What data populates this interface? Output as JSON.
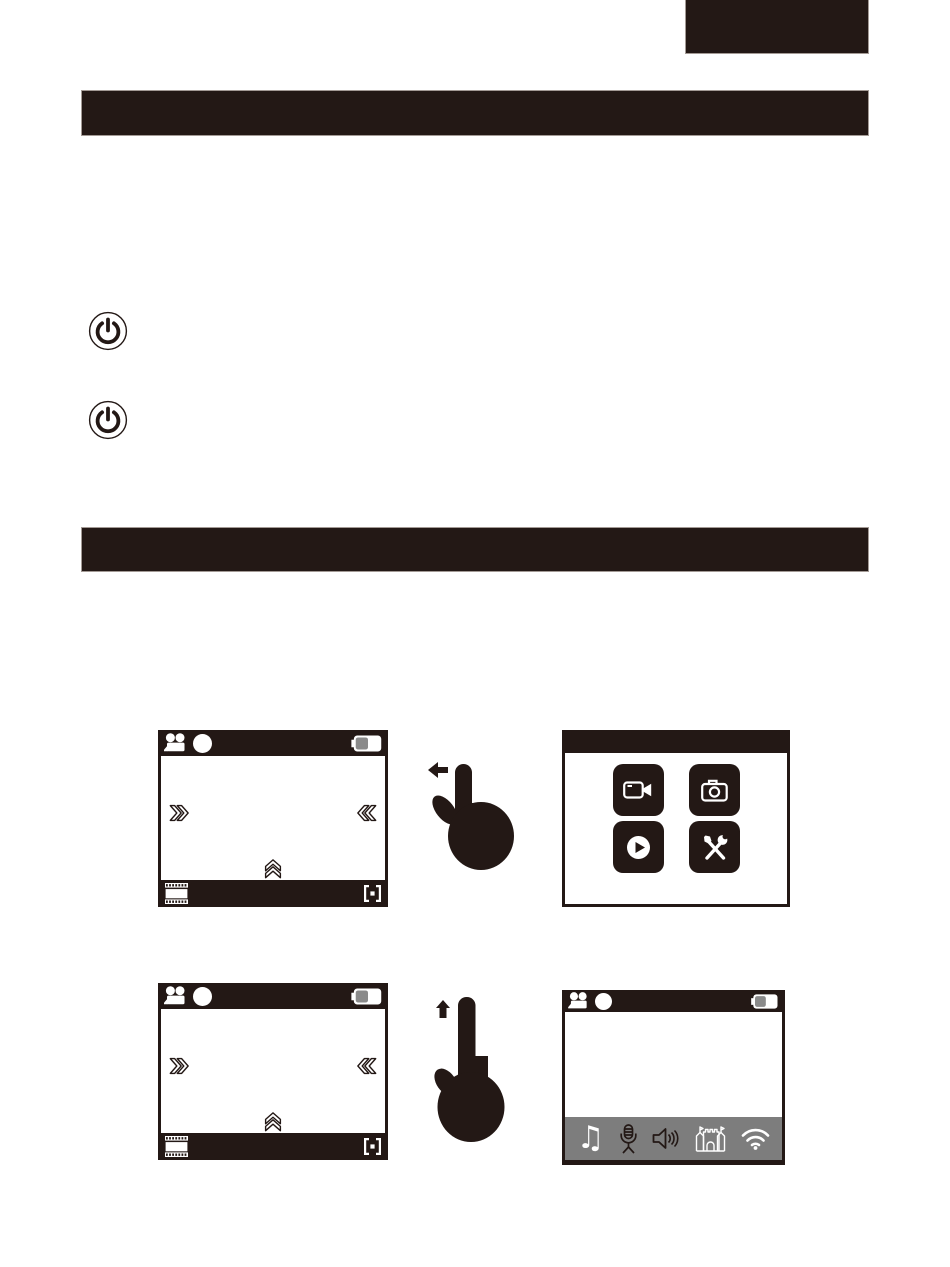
{
  "palette": {
    "ink": "#231815",
    "paper": "#ffffff",
    "toolbar_gray": "#7d7d7d",
    "battery_fill_gray": "#8a8a8a"
  },
  "corner_tab": {
    "text": ""
  },
  "section_bars": [
    {
      "text": ""
    },
    {
      "text": ""
    }
  ],
  "bullets": [
    {
      "icon": "power-icon"
    },
    {
      "icon": "power-icon"
    }
  ],
  "camera_screen_template": {
    "statusbar_icons": [
      "video-recorder-icon",
      "record-dot",
      "battery-icon"
    ],
    "overlay_icons": [
      "double-chevron-right",
      "double-chevron-left",
      "double-chevron-up"
    ],
    "footer_icons": [
      "film-strip-icon",
      "focus-frame-icon"
    ]
  },
  "figure_row1": {
    "left_screen": "camera-live-view",
    "gesture": {
      "icon": "swipe-left-hand-icon",
      "arrow_direction": "left"
    },
    "right_screen": "mode-menu",
    "menu_buttons": [
      {
        "icon": "video-camera-icon"
      },
      {
        "icon": "photo-camera-icon"
      },
      {
        "icon": "play-icon"
      },
      {
        "icon": "tools-icon"
      }
    ]
  },
  "figure_row2": {
    "left_screen": "camera-live-view",
    "gesture": {
      "icon": "swipe-up-hand-icon",
      "arrow_direction": "up"
    },
    "right_screen": "quick-settings",
    "toolbar_icons": [
      {
        "icon": "music-note-icon",
        "glyph": "♫"
      },
      {
        "icon": "microphone-icon"
      },
      {
        "icon": "speaker-icon"
      },
      {
        "icon": "castle-icon"
      },
      {
        "icon": "wifi-icon"
      }
    ]
  }
}
